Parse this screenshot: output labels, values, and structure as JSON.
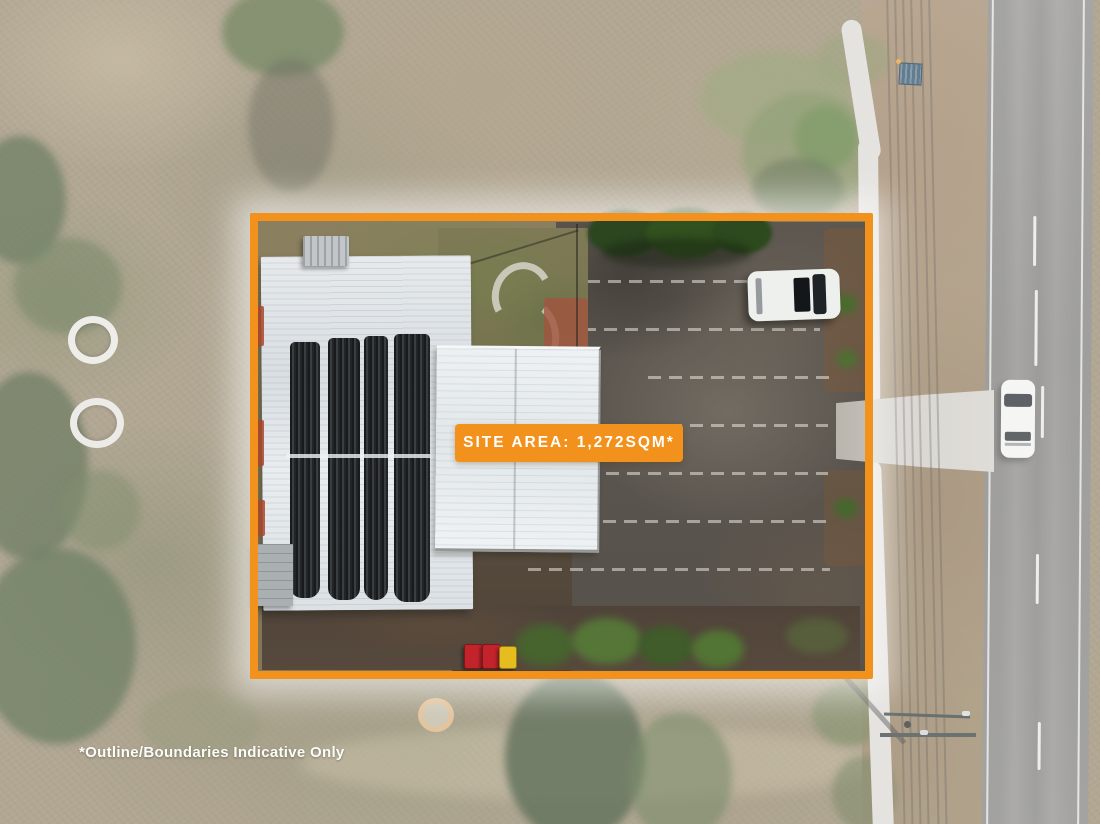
{
  "overlay": {
    "site_area_label": "SITE AREA: 1,272SQM*",
    "disclaimer": "*Outline/Boundaries Indicative Only"
  },
  "colors": {
    "accent_orange": "#F2921D",
    "overlay_text": "#FFFFFF"
  },
  "scene": {
    "type": "aerial-drone-photo",
    "elements": [
      "orange outlined site boundary",
      "building with white metal roof",
      "four rows of dark shade cloth on roof",
      "asphalt parking lot with faded white bay lines",
      "white car parked in lot",
      "white car driving on road",
      "two-lane road with dashed centerline",
      "concrete footpath and driveway crossover",
      "power lines and power pole",
      "red and yellow wheelie bins",
      "scrubland, trees and ring markers"
    ]
  }
}
